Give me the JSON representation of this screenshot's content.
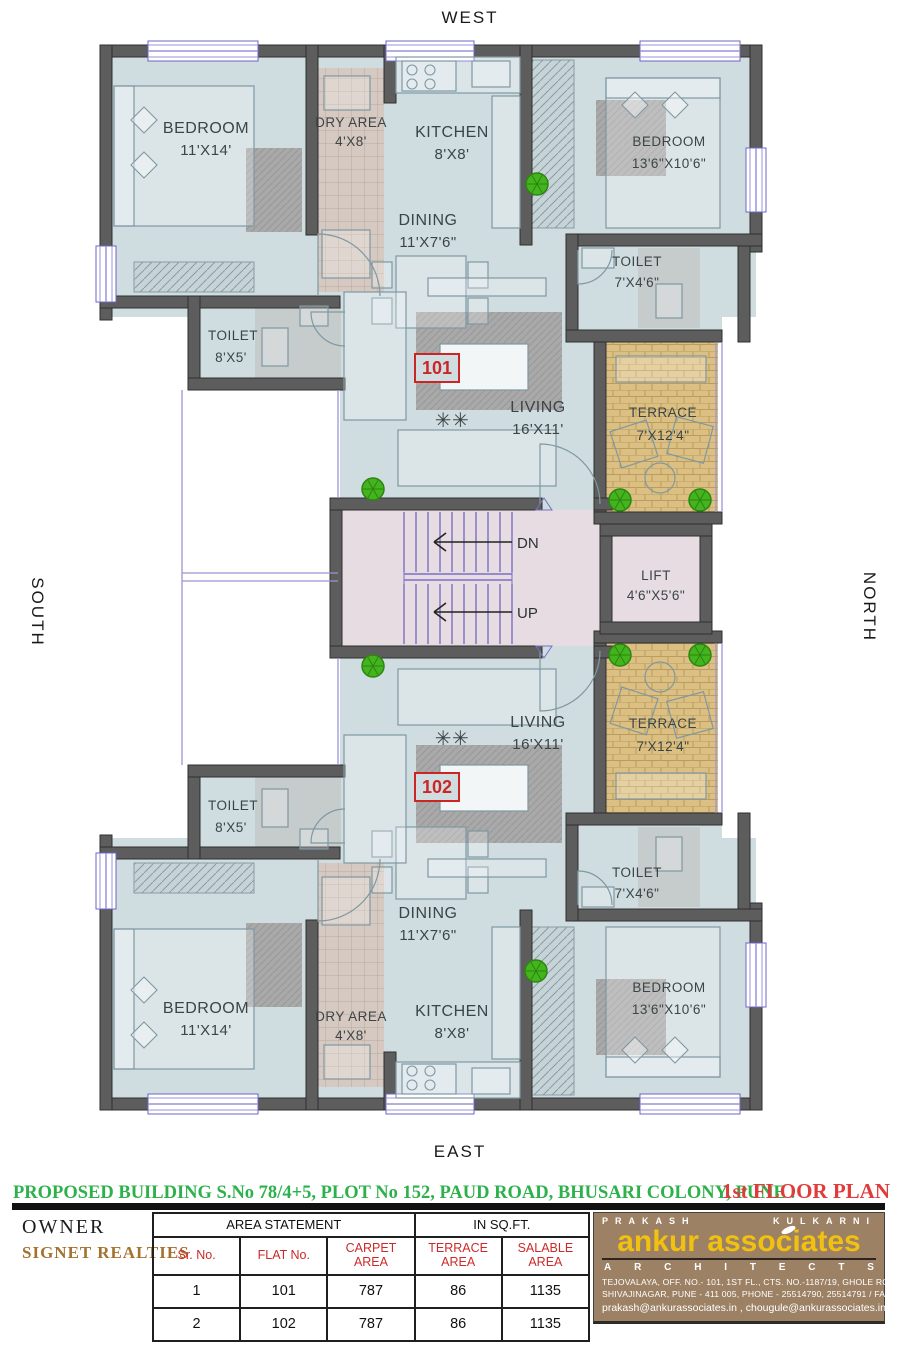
{
  "compass": {
    "west": "WEST",
    "south": "SOUTH",
    "north": "NORTH",
    "east": "EAST"
  },
  "plan": {
    "flat101": {
      "number": "101",
      "bedroom1": {
        "name": "BEDROOM",
        "dims": "11'X14'"
      },
      "dry": {
        "name": "DRY AREA",
        "dims": "4'X8'"
      },
      "kitchen": {
        "name": "KITCHEN",
        "dims": "8'X8'"
      },
      "dining": {
        "name": "DINING",
        "dims": "11'X7'6\""
      },
      "bedroom2": {
        "name": "BEDROOM",
        "dims": "13'6\"X10'6\""
      },
      "toilet1": {
        "name": "TOILET",
        "dims": "8'X5'"
      },
      "toilet2": {
        "name": "TOILET",
        "dims": "7'X4'6\""
      },
      "living": {
        "name": "LIVING",
        "dims": "16'X11'"
      },
      "terrace": {
        "name": "TERRACE",
        "dims": "7'X12'4\""
      }
    },
    "flat102": {
      "number": "102",
      "bedroom1": {
        "name": "BEDROOM",
        "dims": "11'X14'"
      },
      "dry": {
        "name": "DRY AREA",
        "dims": "4'X8'"
      },
      "kitchen": {
        "name": "KITCHEN",
        "dims": "8'X8'"
      },
      "dining": {
        "name": "DINING",
        "dims": "11'X7'6\""
      },
      "bedroom2": {
        "name": "BEDROOM",
        "dims": "13'6\"X10'6\""
      },
      "toilet1": {
        "name": "TOILET",
        "dims": "8'X5'"
      },
      "toilet2": {
        "name": "TOILET",
        "dims": "7'X4'6\""
      },
      "living": {
        "name": "LIVING",
        "dims": "16'X11'"
      },
      "terrace": {
        "name": "TERRACE",
        "dims": "7'X12'4\""
      }
    },
    "lift": {
      "name": "LIFT",
      "dims": "4'6\"X5'6\""
    },
    "stairs": {
      "dn": "DN",
      "up": "UP"
    },
    "decor": {
      "table_flowers": "✳✳"
    }
  },
  "footer": {
    "title_line": "PROPOSED BUILDING S.No 78/4+5, PLOT No 152, PAUD ROAD, BHUSARI COLONY, PUNE .",
    "plan_label": "1st  FLOOR PLAN",
    "owner_label": "OWNER",
    "owner_name": "SIGNET  REALTIES",
    "table": {
      "header1": "AREA STATEMENT",
      "header2": "IN SQ.FT.",
      "columns": [
        "Sr. No.",
        "FLAT No.",
        "CARPET AREA",
        "TERRACE AREA",
        "SALABLE AREA"
      ],
      "rows": [
        [
          "1",
          "101",
          "787",
          "86",
          "1135"
        ],
        [
          "2",
          "102",
          "787",
          "86",
          "1135"
        ]
      ]
    },
    "architect": {
      "name_left": "PRAKASH",
      "name_right": "KULKARNI",
      "brand": "ankur associates",
      "sub_letters": [
        "A",
        "R",
        "C",
        "H",
        "I",
        "T",
        "E",
        "C",
        "T",
        "S"
      ],
      "address1": "TEJOVALAYA, OFF. NO.- 101, 1ST FL., CTS. NO.-1187/19, GHOLE ROAD,",
      "address2": "SHIVAJINAGAR, PUNE - 411 005, PHONE - 25514790, 25514791 / FAX - 020 25514792",
      "emails": "prakash@ankurassociates.in , chougule@ankurassociates.in"
    },
    "colors": {
      "accent_green": "#2db14b",
      "accent_red": "#e13c3c",
      "brand_yellow": "#f2c110",
      "brand_brown": "#9c8164",
      "owner_brown": "#a5722e"
    }
  }
}
